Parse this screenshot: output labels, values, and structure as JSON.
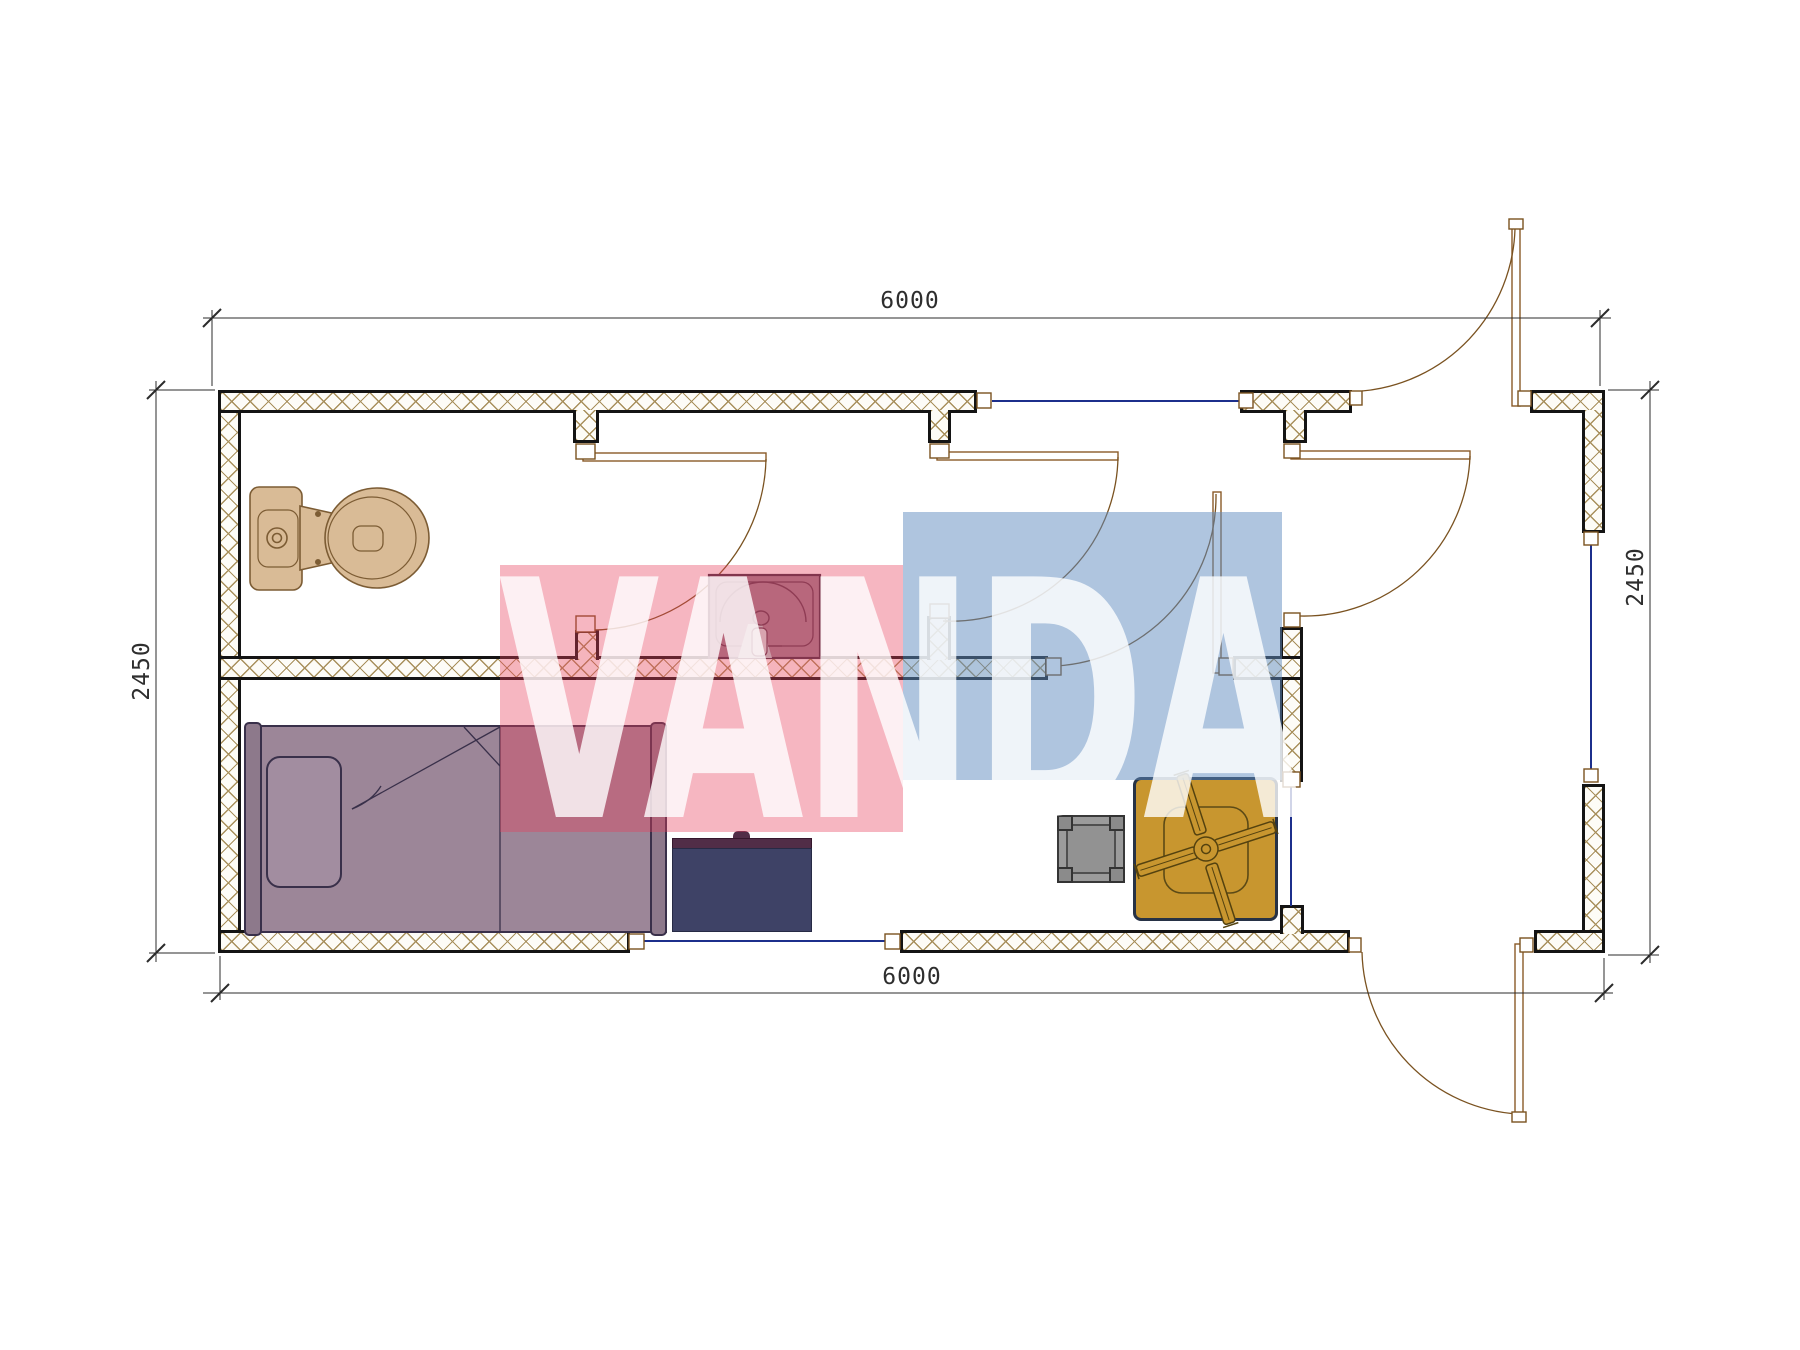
{
  "drawing": {
    "type": "architectural-floor-plan",
    "description": "Single-module cabin floor plan with WC, shower room, bedroom and entrance porch"
  },
  "dimensions": {
    "top": "6000",
    "bottom": "6000",
    "left": "2450",
    "right": "2450"
  },
  "watermark": {
    "text": "VANDA",
    "pink_color": "rgba(232,62,92,0.38)",
    "blue_color": "rgba(96,140,192,0.50)",
    "letter_color": "rgba(255,255,255,0.80)"
  },
  "fixtures": [
    {
      "icon": "toilet-icon",
      "color": "#d9bb96"
    },
    {
      "icon": "washbasin-icon",
      "color": "#9b8090"
    },
    {
      "icon": "single-bed-icon",
      "color": "#9c8698"
    },
    {
      "icon": "desk-icon",
      "color": "#3e4266"
    },
    {
      "icon": "stool-icon",
      "color": "#9b9b9b"
    },
    {
      "icon": "table-with-fan-icon",
      "color": "#c8962f"
    }
  ],
  "openings": {
    "doors": 6,
    "windows": 4
  },
  "colors": {
    "wall_hatch": "#a8905c",
    "wall_outline": "#141414",
    "door_line": "#7a5220",
    "window_line": "#1c2f8c",
    "dimension_line": "#2b2b2b"
  }
}
